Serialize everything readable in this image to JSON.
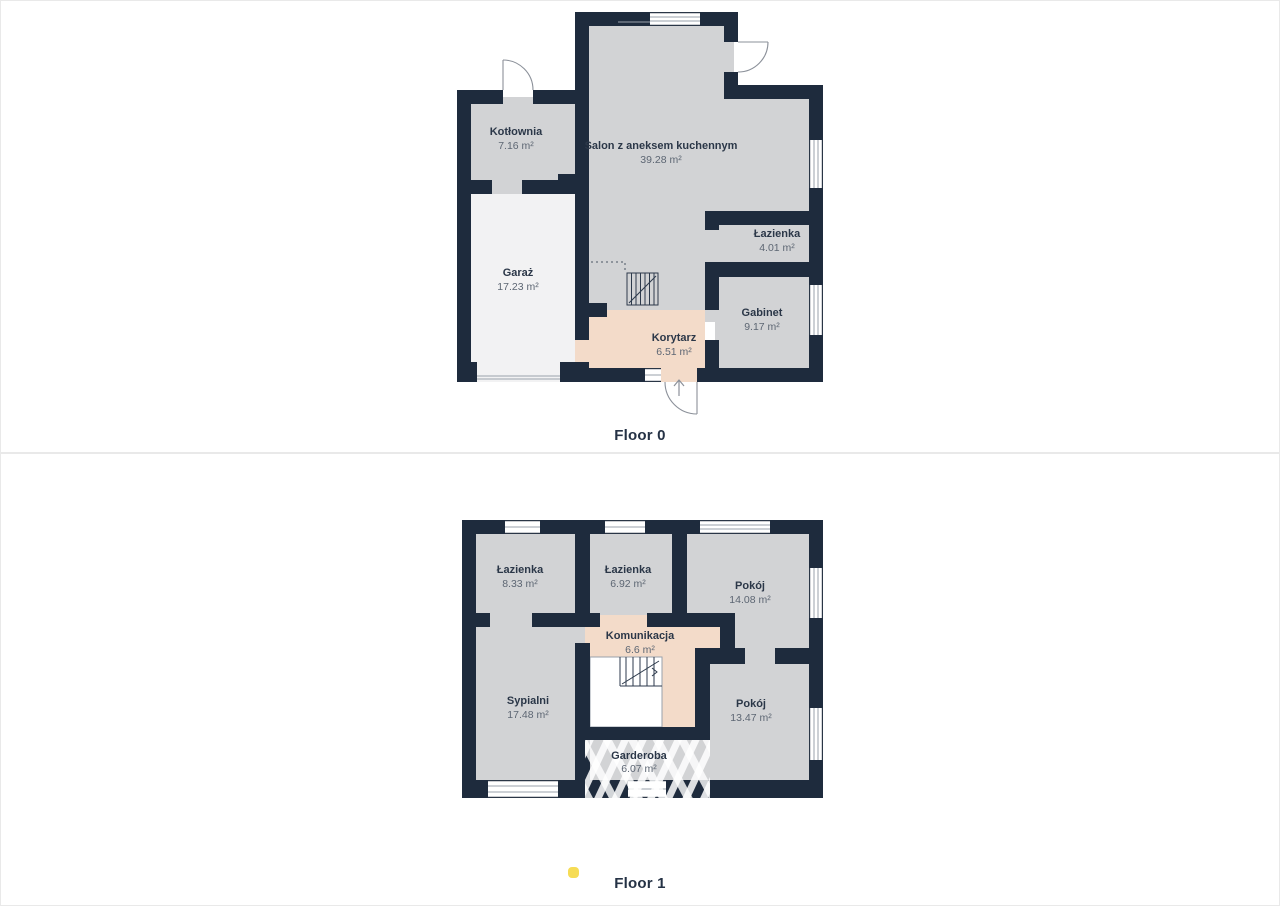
{
  "floors": [
    {
      "label": "Floor 0",
      "rooms": [
        {
          "name": "Kotłownia",
          "area": "7.16 m²"
        },
        {
          "name": "Salon z aneksem kuchennym",
          "area": "39.28 m²"
        },
        {
          "name": "Garaż",
          "area": "17.23 m²"
        },
        {
          "name": "Łazienka",
          "area": "4.01 m²"
        },
        {
          "name": "Gabinet",
          "area": "9.17 m²"
        },
        {
          "name": "Korytarz",
          "area": "6.51 m²"
        }
      ]
    },
    {
      "label": "Floor 1",
      "rooms": [
        {
          "name": "Łazienka",
          "area": "8.33 m²"
        },
        {
          "name": "Łazienka",
          "area": "6.92 m²"
        },
        {
          "name": "Pokój",
          "area": "14.08 m²"
        },
        {
          "name": "Komunikacja",
          "area": "6.6 m²"
        },
        {
          "name": "Sypialni",
          "area": "17.48 m²"
        },
        {
          "name": "Pokój",
          "area": "13.47 m²"
        },
        {
          "name": "Garderoba",
          "area": "6.07 m²"
        }
      ]
    }
  ],
  "colors": {
    "wall": "#1e2b3d",
    "room_fill": "#d2d3d5",
    "corridor_fill": "#f3dbc9",
    "garage_fill": "#f2f2f3",
    "room_name_text": "#2b3748",
    "area_text": "#5d6673",
    "caption_text": "#253245",
    "marker_yellow": "#f6dc55",
    "panel_border": "#e9e9e9"
  }
}
